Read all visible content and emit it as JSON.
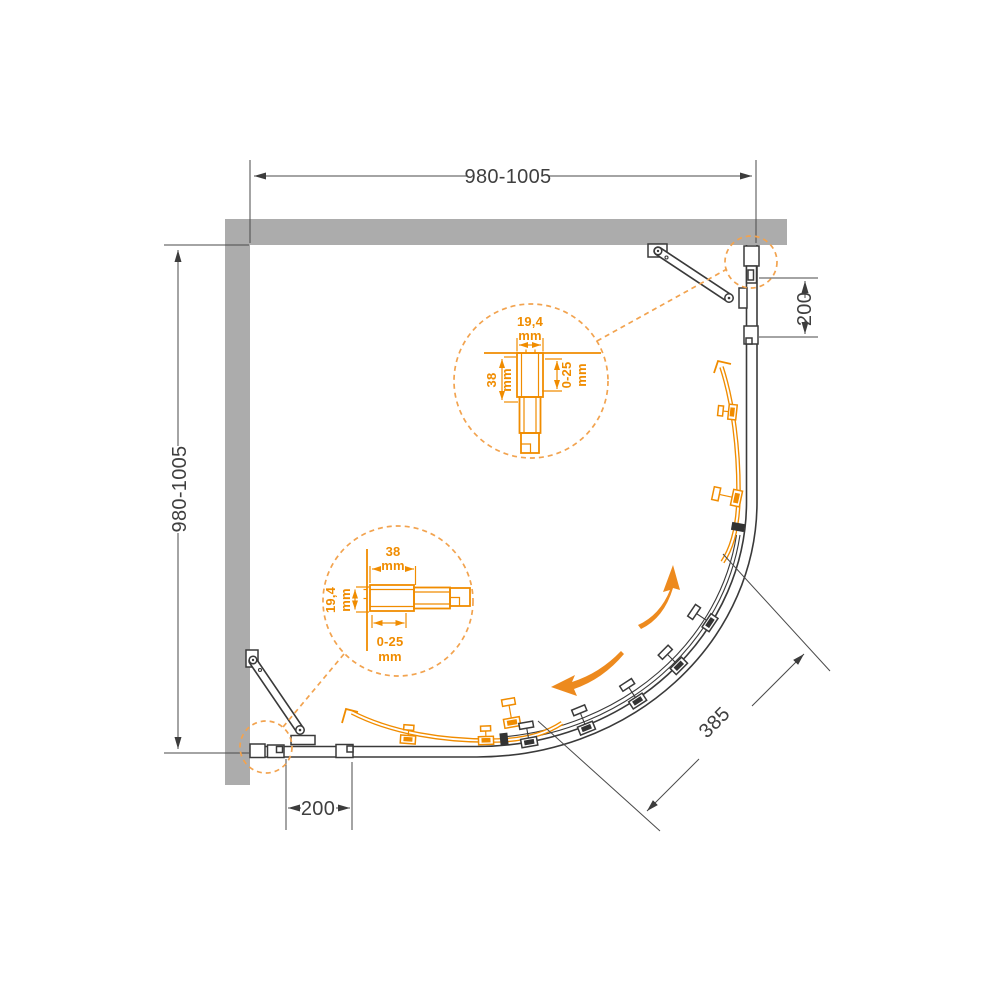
{
  "colors": {
    "accent_orange": "#F08C00",
    "callout_orange": "#F2A34F",
    "drawing_line": "#3A3A3A",
    "wall_gray": "#ACACAC"
  },
  "dimensions": {
    "top_width": "980-1005",
    "left_depth": "980-1005",
    "right_panel_offset": "200",
    "bottom_panel_offset": "200",
    "door_radius": "385"
  },
  "profile_detail_top": {
    "width": "19,4",
    "width_unit": "mm",
    "depth": "38",
    "depth_unit": "mm",
    "adjustment": "0-25",
    "adjustment_unit": "mm"
  },
  "profile_detail_bottom": {
    "width": "38",
    "width_unit": "mm",
    "depth": "19,4",
    "depth_unit": "mm",
    "adjustment": "0-25",
    "adjustment_unit": "mm"
  }
}
